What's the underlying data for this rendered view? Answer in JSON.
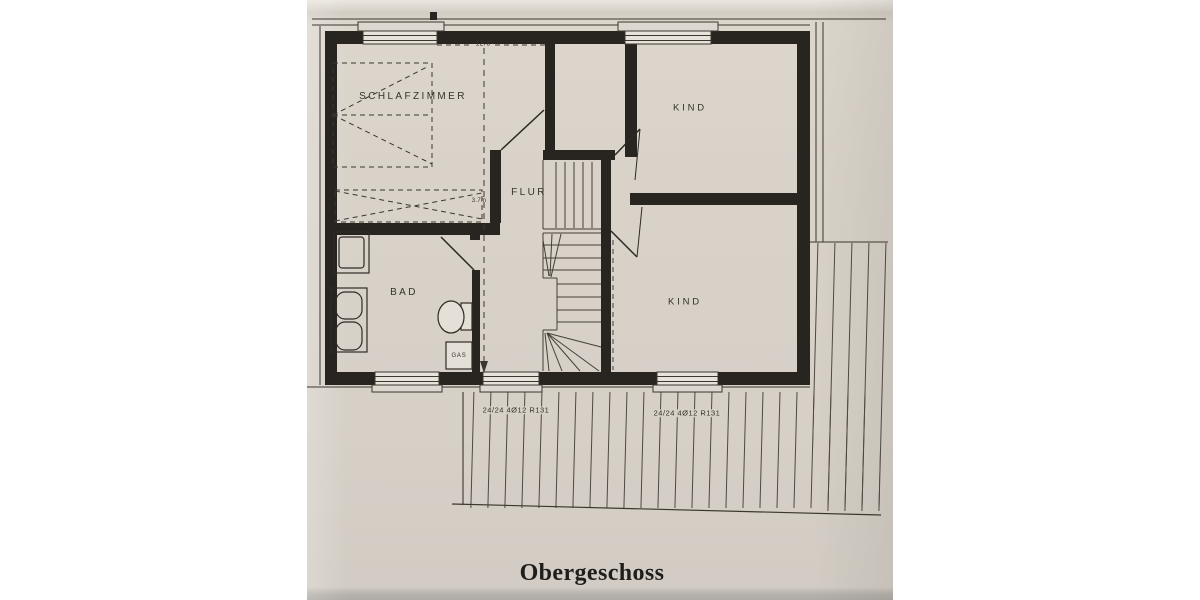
{
  "floorplan": {
    "caption": "Obergeschoss",
    "rooms": {
      "schlafzimmer": "SCHLAFZIMMER",
      "kind_top": "KIND",
      "kind_bottom": "KIND",
      "flur": "FLUR",
      "bad": "BAD",
      "gas": "GAS"
    },
    "annotations": {
      "beam": "12/8",
      "depth": "3.7m",
      "lintel_left": "24/24 4Ø12 R131",
      "lintel_right": "24/24 4Ø12 R131"
    },
    "colors": {
      "paper": "#d8d2c9",
      "ink": "#282420",
      "margin": "#ffffff"
    }
  }
}
